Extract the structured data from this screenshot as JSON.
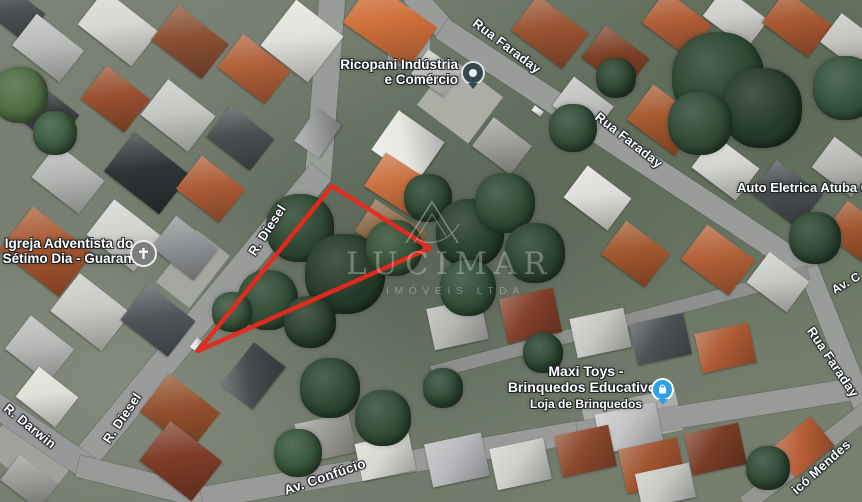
{
  "map": {
    "view": "satellite",
    "watermark": {
      "brand": "LUCIMAR",
      "subtitle": "IMÓVEIS LTDA"
    },
    "highlight": {
      "color": "#e8291c",
      "points": "332,186 430,248 198,351"
    },
    "street_labels": [
      {
        "text": "Rua Faraday",
        "x": 507,
        "y": 46,
        "rot": 37,
        "size": 13
      },
      {
        "text": "Rua Faraday",
        "x": 629,
        "y": 140,
        "rot": 38,
        "size": 13
      },
      {
        "text": "Rua Faraday",
        "x": 833,
        "y": 362,
        "rot": 56,
        "size": 13
      },
      {
        "text": "R. Diesel",
        "x": 267,
        "y": 230,
        "rot": -57,
        "size": 13
      },
      {
        "text": "R. Diesel",
        "x": 122,
        "y": 418,
        "rot": -56,
        "size": 13
      },
      {
        "text": "R. Darwin",
        "x": 30,
        "y": 426,
        "rot": 39,
        "size": 13
      },
      {
        "text": "Av. Confúcio",
        "x": 325,
        "y": 477,
        "rot": -19,
        "size": 13.5
      },
      {
        "text": "Av. C",
        "x": 846,
        "y": 283,
        "rot": -30,
        "size": 12
      },
      {
        "text": "icó Mendes",
        "x": 821,
        "y": 467,
        "rot": -42,
        "size": 13
      }
    ],
    "places": {
      "ricopani": {
        "line1": "Ricopani Indústria",
        "line2": "e Comércio",
        "icon": "poi-pin",
        "icon_color": "#36474f"
      },
      "igreja": {
        "line1": "Igreja Adventista do",
        "line2": "Sétimo Dia - Guarani",
        "icon": "church-pin",
        "icon_color": "#7b7d7e"
      },
      "auto_eletrica": {
        "line1": "Auto Eletrica Atuba C",
        "icon": "none"
      },
      "maxi_toys": {
        "line1": "Maxi Toys -",
        "line2": "Brinquedos Educativos",
        "line3": "Loja de Brinquedos",
        "icon": "shopping-pin",
        "icon_color": "#2da0e8"
      }
    }
  }
}
